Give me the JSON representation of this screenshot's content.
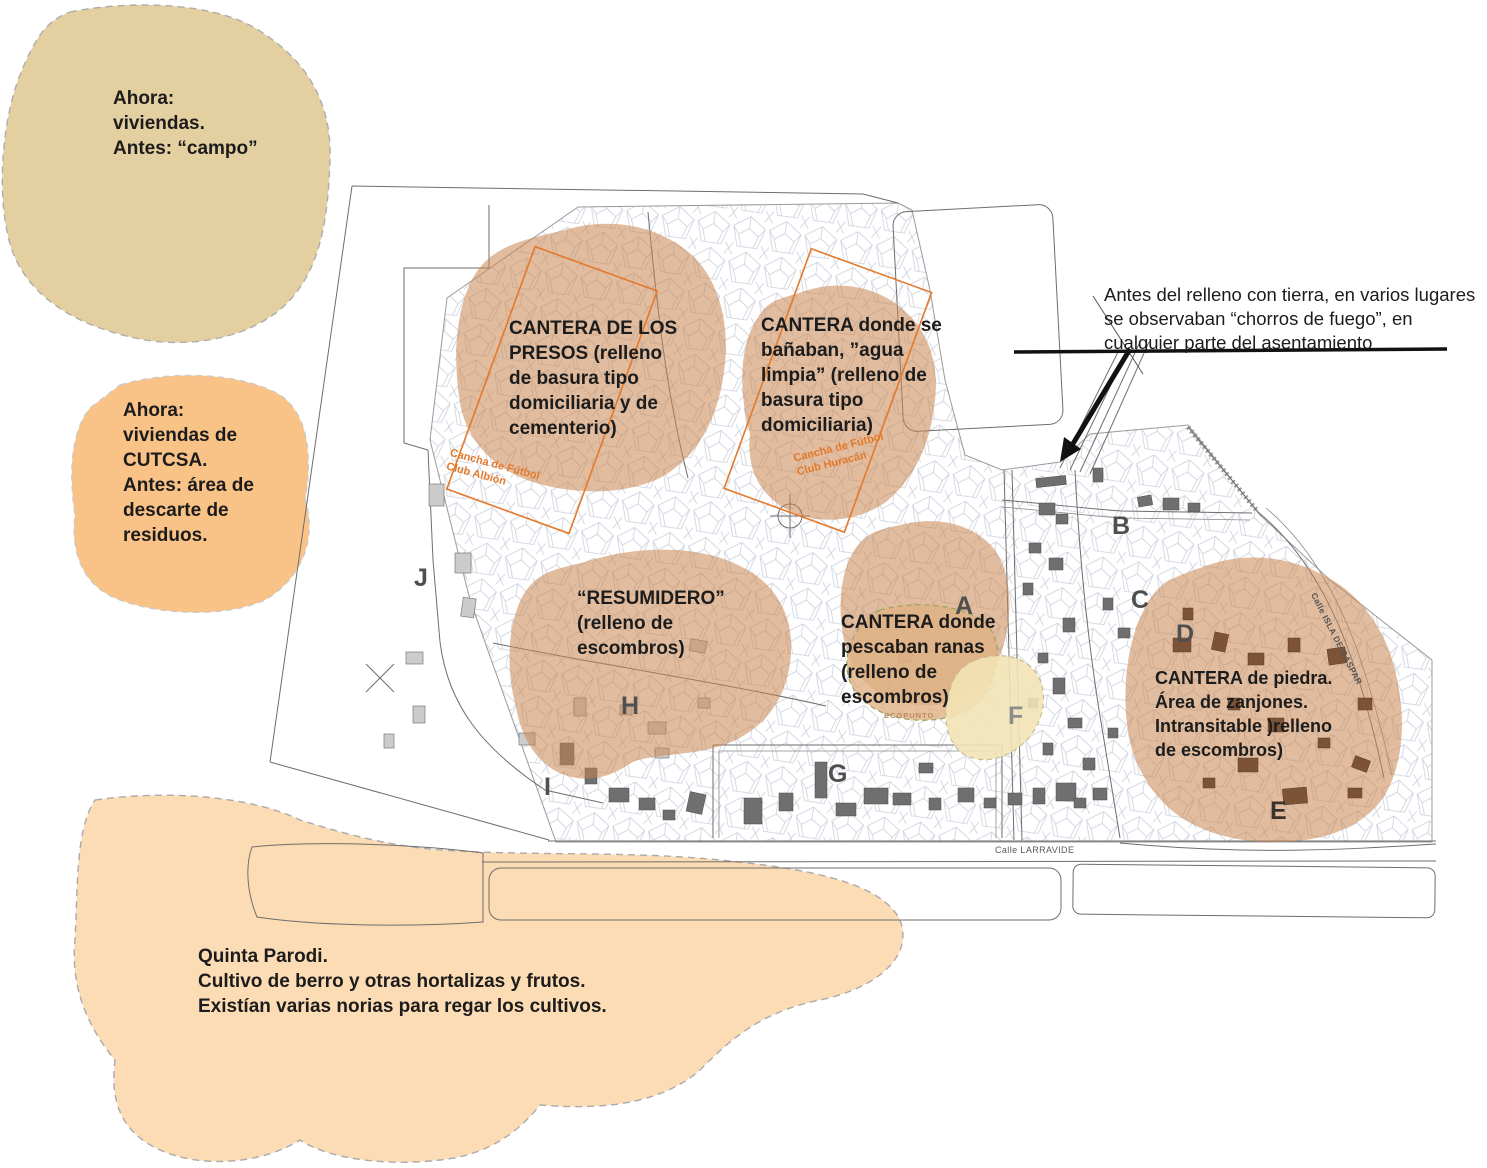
{
  "colors": {
    "tan_blob": "#e4cfa1",
    "orange_blob": "#f9c287",
    "peach_blob": "#fcdcb4",
    "brown_blob": "#d5a076",
    "cream_blob": "#f3e3b5",
    "accent_orange": "#e4792b"
  },
  "notes": {
    "ahora_viviendas": "Ahora:\nviviendas.\nAntes: “campo”",
    "cutcsa": "Ahora:\nviviendas de\nCUTCSA.\nAntes: área de\ndescarte de\nresiduos.",
    "quinta_parodi": "Quinta Parodi.\nCultivo de berro y otras hortalizas y frutos.\nExistían varias norias para regar los cultivos.",
    "chorros_fuego": "Antes del relleno con tierra, en varios lugares\nse observaban “chorros de fuego”, en\ncualquier parte del asentamiento"
  },
  "map_labels": {
    "cantera_presos": "CANTERA DE LOS\nPRESOS (relleno\nde basura tipo\ndomiciliaria y de\ncementerio)",
    "cantera_banaban": "CANTERA donde se\nbañaban, ”agua\nlimpia” (relleno de\nbasura tipo\ndomiciliaria)",
    "resumidero": "“RESUMIDERO”\n(relleno de\nescombros)",
    "cantera_ranas": "CANTERA donde\npescaban ranas\n(relleno de\nescombros)",
    "cantera_piedra": "CANTERA de piedra.\nÁrea de zanjones.\nIntransitable )relleno\nde escombros)",
    "cancha_albion": "Cancha de Fútbol\nClub Albión",
    "cancha_huracan": "Cancha de Fútbol\nClub Huracán",
    "ecopunto": "ECOPUNTO"
  },
  "streets": {
    "larravide": "Calle LARRAVIDE",
    "isla_de_gaspar": "Calle ISLA DE GASPAR"
  },
  "zone_letters": [
    "A",
    "B",
    "C",
    "D",
    "E",
    "F",
    "G",
    "H",
    "I",
    "J"
  ]
}
